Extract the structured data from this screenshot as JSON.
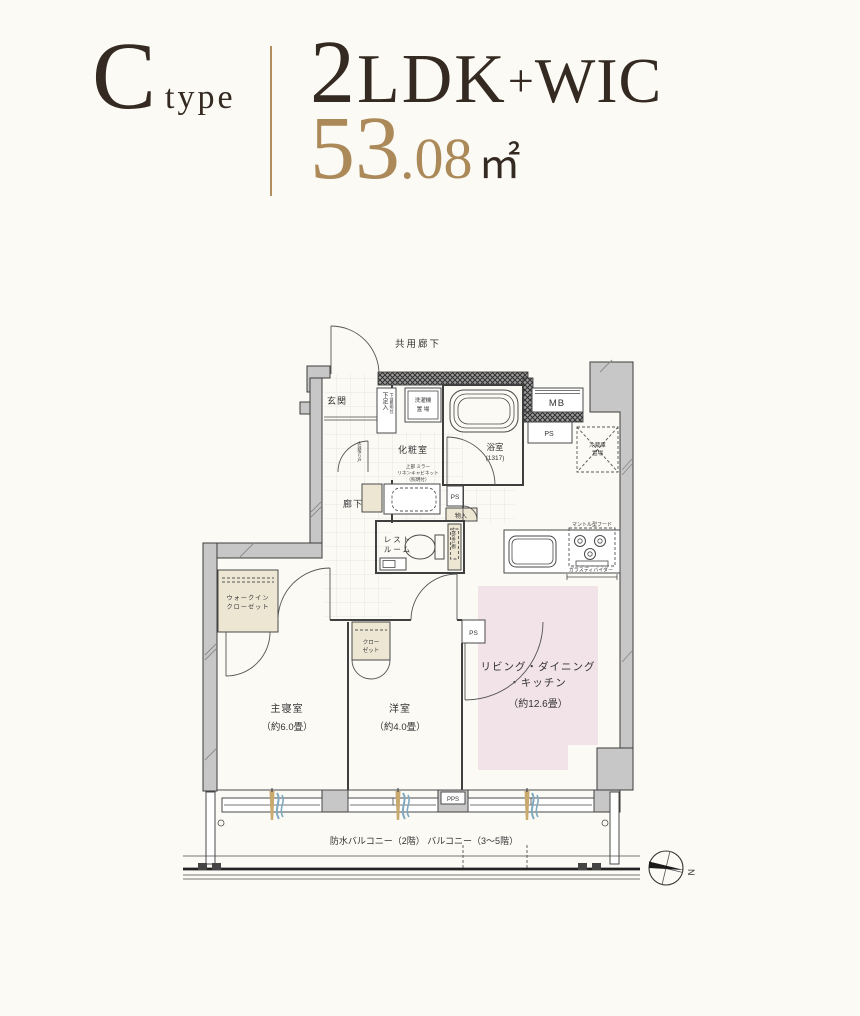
{
  "header": {
    "type_letter": "C",
    "type_word": "type",
    "rooms_num": "2",
    "rooms_ldk": "LDK",
    "rooms_plus": "+",
    "rooms_wic": "WIC",
    "area_int": "53",
    "area_frac": ".08",
    "area_unit": "㎡"
  },
  "colors": {
    "accent_gold": "#ab8958",
    "ink": "#342a22",
    "ldk_pink": "#f2e3e9",
    "closet_beige": "#ece6d3",
    "wall_gray": "#c7c7c7"
  },
  "plan": {
    "labels": {
      "common_corridor": "共用廊下",
      "entrance": "玄関",
      "shoe_box": "下足入",
      "shoe_box_note": "（下部照明付）",
      "washer_1": "洗濯機",
      "washer_2": "置 場",
      "bath": "浴室",
      "bath_size": "(1317)",
      "powder_room": "化粧室",
      "mirror_note_1": "上部 ミラー",
      "mirror_note_2": "リネンキャビネット",
      "mirror_note_3": "（照明付）",
      "corridor": "廊下",
      "hall_door_note": "太鼓張り戸",
      "ps": "PS",
      "pps": "PPS",
      "mb": "MB",
      "storage": "物入",
      "restroom_1": "レスト",
      "restroom_2": "ルーム",
      "upper_cabinet": "上部吊戸棚",
      "fridge_1": "冷蔵庫",
      "fridge_2": "置場",
      "hood_note": "マントル型フード",
      "divider_note": "ガラスディバイダー",
      "ldk_1": "リビング・ダイニング",
      "ldk_2": "・キッチン",
      "ldk_size": "（約12.6畳）",
      "wic_1": "ウォークイン",
      "wic_2": "クローゼット",
      "master": "主寝室",
      "master_size": "（約6.0畳）",
      "western": "洋室",
      "western_size": "（約4.0畳）",
      "closet_1": "クロー",
      "closet_2": "ゼット",
      "balcony": "防水バルコニー（2階） バルコニー（3〜5階）",
      "compass_n": "N"
    }
  }
}
